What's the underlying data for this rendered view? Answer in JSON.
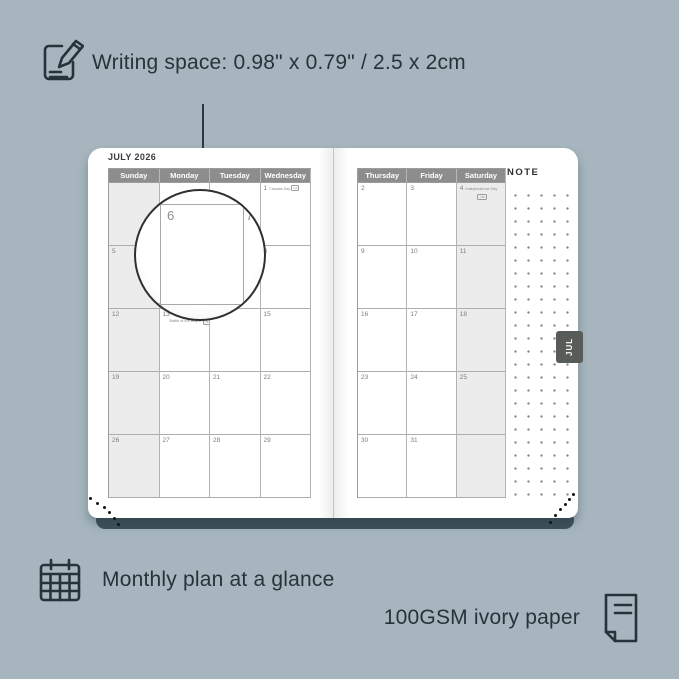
{
  "colors": {
    "background": "#a7b6be",
    "ink": "#26333b",
    "cover_edge": "#3f525a",
    "header_bg": "#8d8d8d",
    "header_text": "#ffffff",
    "shaded_column": "#ececec",
    "page": "#ffffff",
    "tab_bg": "#585c59",
    "tab_text": "#ffffff"
  },
  "annotations": {
    "writing_space": "Writing space: 0.98\" x 0.79\" / 2.5 x 2cm",
    "monthly_plan": "Monthly plan at a glance",
    "paper": "100GSM ivory paper"
  },
  "planner": {
    "month_title": "JULY 2026",
    "tab_label": "JUL",
    "note_label": "NOTE",
    "left_page": {
      "day_headers": [
        "Sunday",
        "Monday",
        "Tuesday",
        "Wednesday"
      ],
      "shaded_column_index": 0,
      "rows": [
        [
          {},
          {},
          {},
          {
            "n": "1",
            "holiday": "Canada Day",
            "badge": "CA",
            "layout": "inline"
          }
        ],
        [
          {
            "n": "5"
          },
          {
            "n": "6"
          },
          {
            "n": "7"
          },
          {
            "n": "8"
          }
        ],
        [
          {
            "n": "12"
          },
          {
            "n": "13",
            "holiday": "Battle of the Boyne",
            "badge": "UK",
            "layout": "below"
          },
          {
            "n": "14"
          },
          {
            "n": "15"
          }
        ],
        [
          {
            "n": "19"
          },
          {
            "n": "20"
          },
          {
            "n": "21"
          },
          {
            "n": "22"
          }
        ],
        [
          {
            "n": "26"
          },
          {
            "n": "27"
          },
          {
            "n": "28"
          },
          {
            "n": "29"
          }
        ]
      ]
    },
    "right_page": {
      "day_headers": [
        "Thursday",
        "Friday",
        "Saturday"
      ],
      "shaded_column_index": 2,
      "rows": [
        [
          {
            "n": "2"
          },
          {
            "n": "3"
          },
          {
            "n": "4",
            "holiday": "Independence Day",
            "badge": "US",
            "layout": "badge-below"
          }
        ],
        [
          {
            "n": "9"
          },
          {
            "n": "10"
          },
          {
            "n": "11"
          }
        ],
        [
          {
            "n": "16"
          },
          {
            "n": "17"
          },
          {
            "n": "18"
          }
        ],
        [
          {
            "n": "23"
          },
          {
            "n": "24"
          },
          {
            "n": "25"
          }
        ],
        [
          {
            "n": "30"
          },
          {
            "n": "31"
          },
          {}
        ]
      ]
    },
    "magnifier": {
      "day_left": "6",
      "day_right": "7"
    }
  }
}
